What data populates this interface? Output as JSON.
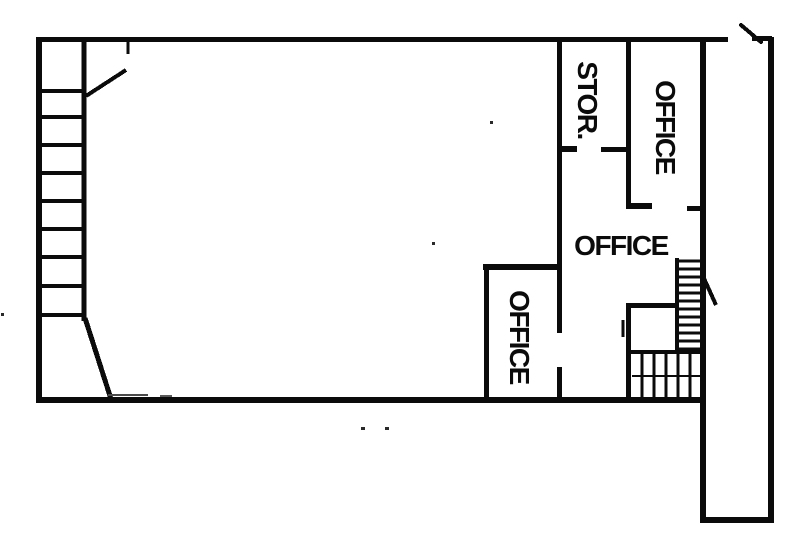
{
  "drawing_type": "architectural floor plan",
  "background_color": "#ffffff",
  "line_color": "#0b0b0b",
  "rooms": [
    {
      "id": "storage",
      "label": "STOR.",
      "orientation": "vertical"
    },
    {
      "id": "office-top-right",
      "label": "OFFICE",
      "orientation": "vertical"
    },
    {
      "id": "office-middle",
      "label": "OFFICE",
      "orientation": "horizontal"
    },
    {
      "id": "office-lower-left",
      "label": "OFFICE",
      "orientation": "vertical"
    }
  ]
}
